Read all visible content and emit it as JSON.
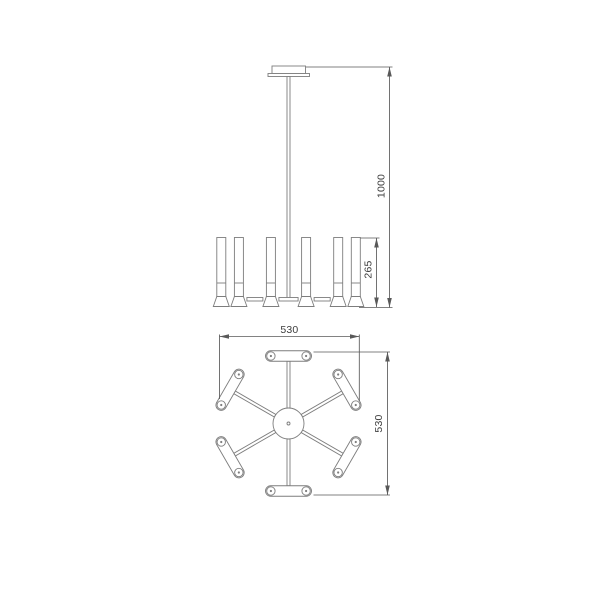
{
  "page": {
    "background": "#ffffff"
  },
  "drawing": {
    "type": "technical-dimension-drawing",
    "subject": "six-arm chandelier, front elevation and plan view",
    "colors": {
      "line": "#7d7d7d",
      "dimension_line": "#595959",
      "text": "#3d3d3d"
    },
    "views": {
      "elevation": {
        "name": "front-elevation",
        "dimensions": {
          "overall_drop": {
            "value": "1000",
            "orientation": "vertical"
          },
          "body_height": {
            "value": "265",
            "orientation": "vertical"
          }
        }
      },
      "plan": {
        "name": "plan-view",
        "arm_count": 6,
        "dimensions": {
          "width": {
            "value": "530",
            "orientation": "horizontal"
          },
          "depth": {
            "value": "530",
            "orientation": "vertical"
          }
        }
      }
    }
  }
}
